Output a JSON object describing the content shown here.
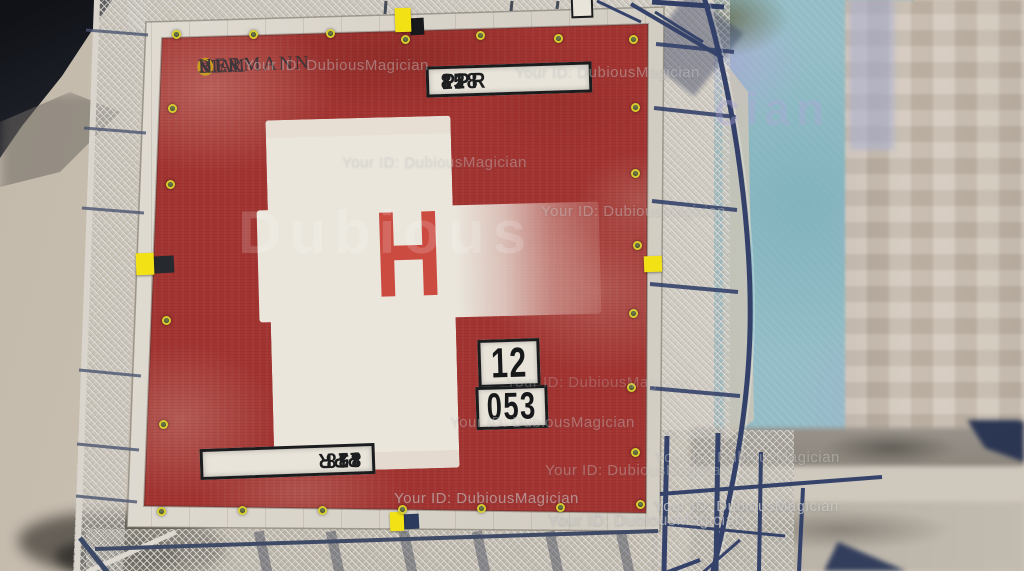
{
  "watermarks": {
    "id_text": "Your ID: DubiousMagician",
    "big_overlay_text": "Dubious",
    "tarp_overlay_fragment": "cian"
  },
  "helipad": {
    "hospital_name": {
      "prefix": "MEM",
      "ringed_letter": "O",
      "suffix": "RIAL",
      "line2": "HERMANN"
    },
    "center_marking": "H",
    "ppr_sign": {
      "code": "PPR",
      "number1": "128",
      "number2": "85"
    },
    "pad_id_sign": {
      "top": "12",
      "bottom": "053"
    }
  },
  "colors": {
    "pad_red": "#a23431",
    "pad_border": "#d9d4ca",
    "cross_white": "#eae6dc",
    "marking_red": "#cb4b40",
    "sign_bg": "#e8e4da",
    "sign_border": "#1b1c1e",
    "marker_yellow": "#f2e215",
    "fence_blue": "#35436b",
    "mesh_gray": "#c6c3bc",
    "tarp_teal": "#93bcc6",
    "facade_beige": "#c9bdb0",
    "concrete": "#cdc3b5",
    "dark_structure": "#16181d",
    "watermark_gray": "#c9c9c9",
    "logo_dark": "#2d3339"
  }
}
